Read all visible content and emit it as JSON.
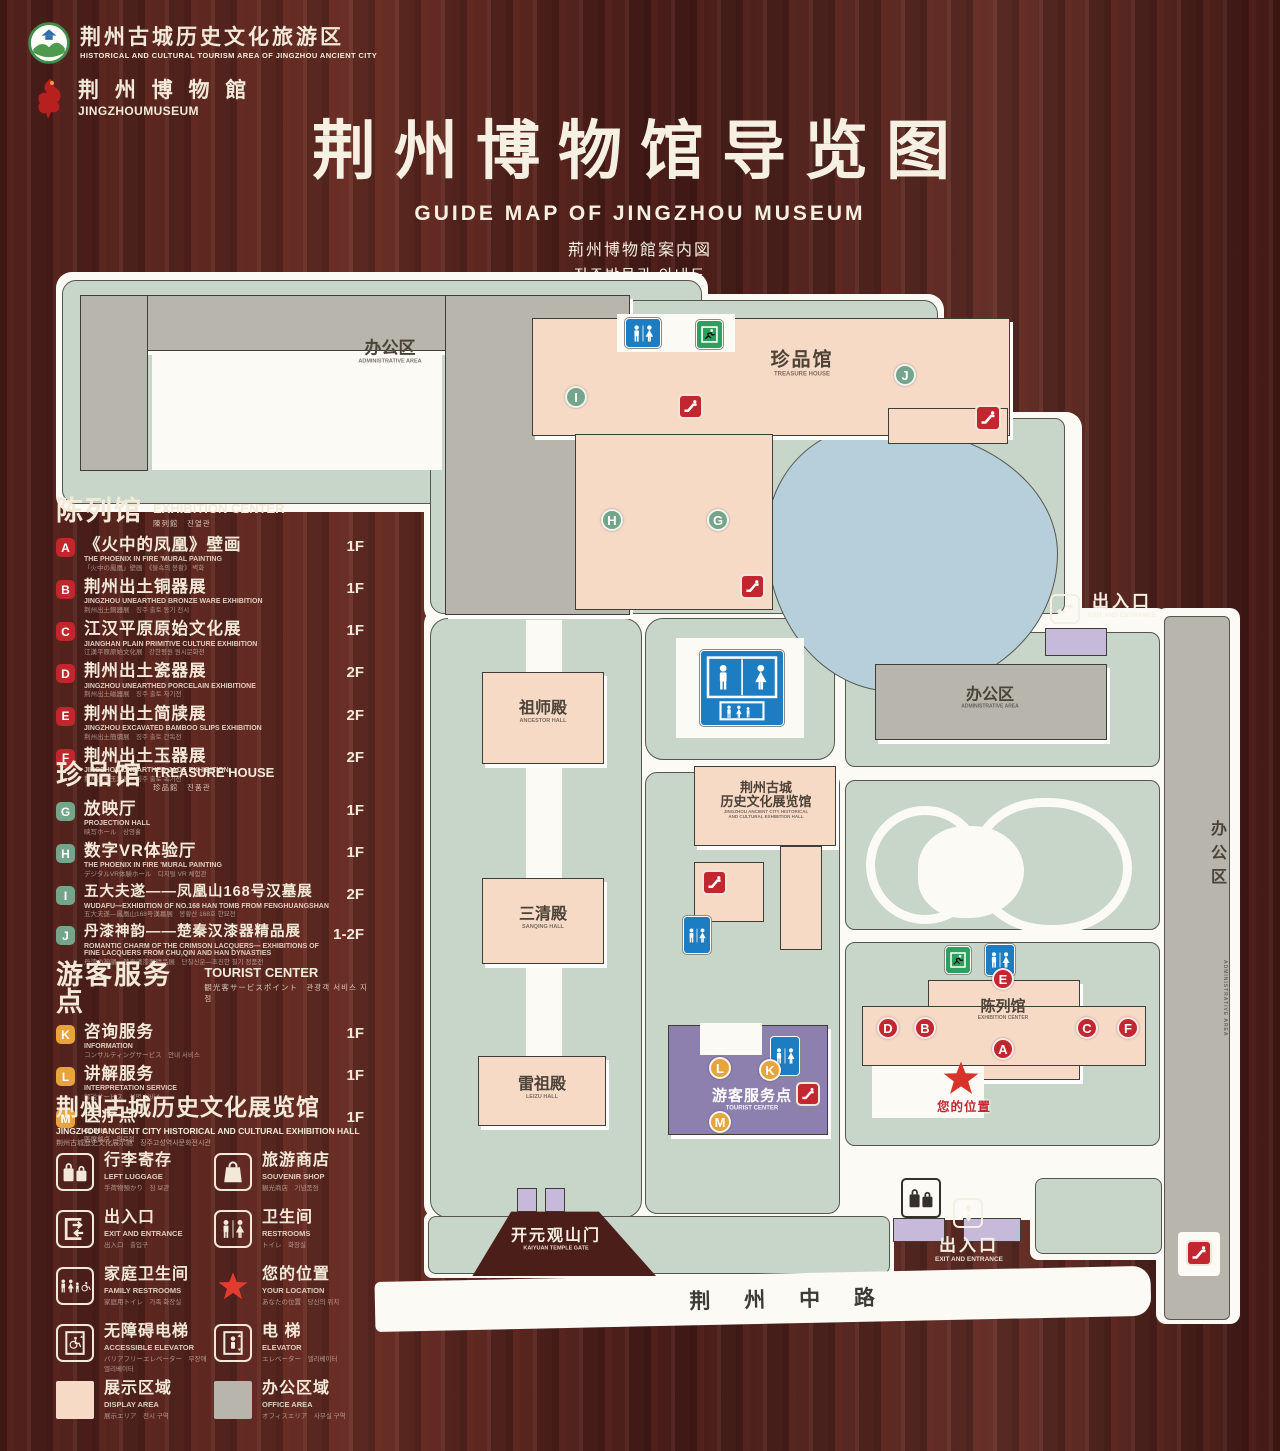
{
  "header": {
    "logo1": {
      "zh": "荆州古城历史文化旅游区",
      "en": "HISTORICAL AND CULTURAL TOURISM AREA OF JINGZHOU ANCIENT CITY"
    },
    "logo2": {
      "zh": "荆 州 博 物 館",
      "en": "JINGZHOUMUSEUM"
    },
    "title_zh": "荆州博物馆导览图",
    "title_en": "GUIDE MAP OF JINGZHOU MUSEUM",
    "title_ja": "荊州博物館案内図",
    "title_ko": "징주박물관 안내도"
  },
  "legend": {
    "exhibition": {
      "title_zh": "陈列馆",
      "title_en": "EXHIBITION CENTER",
      "title_sub": "陳列館　진열관",
      "items": [
        {
          "letter": "A",
          "zh": "《火中的凤凰》壁画",
          "en": "THE PHOENIX IN FIRE 'MURAL PAINTING",
          "sub": "「火中の鳳凰」壁画　《불속의 봉황》 벽화",
          "floor": "1F"
        },
        {
          "letter": "B",
          "zh": "荆州出土铜器展",
          "en": "JINGZHOU UNEARTHED BRONZE WARE EXHIBITION",
          "sub": "荆州出土銅器展　징주 출토 동기 전시",
          "floor": "1F"
        },
        {
          "letter": "C",
          "zh": "江汉平原原始文化展",
          "en": "JIANGHAN PLAIN PRIMITIVE CULTURE EXHIBITION",
          "sub": "江漢平原原始文化展　강한평원 원시문화전",
          "floor": "1F"
        },
        {
          "letter": "D",
          "zh": "荆州出土瓷器展",
          "en": "JINGZHOU UNEARTHED PORCELAIN EXHIBITIONE",
          "sub": "荆州出土磁器展　징주 출토 자기전",
          "floor": "2F"
        },
        {
          "letter": "E",
          "zh": "荆州出土简牍展",
          "en": "JINGZHOU EXCAVATED BAMBOO SLIPS EXHIBITION",
          "sub": "荆州出土簡牘展　징주 출토 간독전",
          "floor": "2F"
        },
        {
          "letter": "F",
          "zh": "荆州出土玉器展",
          "en": "JINGZHOU UNEARTHED JADE EXHIBITION",
          "sub": "荆州出土玉器展　징주 출토 옥기전",
          "floor": "2F"
        }
      ]
    },
    "treasure": {
      "title_zh": "珍品馆",
      "title_en": "TREASURE HOUSE",
      "title_sub": "珍品館　진품관",
      "items": [
        {
          "letter": "G",
          "zh": "放映厅",
          "en": "PROJECTION HALL",
          "sub": "映写ホール　상영홀",
          "floor": "1F"
        },
        {
          "letter": "H",
          "zh": "数字VR体验厅",
          "en": "THE PHOENIX IN FIRE 'MURAL PAINTING",
          "sub": "デジタルVR体験ホール　디지털 VR 체험관",
          "floor": "1F"
        },
        {
          "letter": "I",
          "zh": "五大夫遂——凤凰山168号汉墓展",
          "en": "WUDAFU—EXHIBITION OF NO.168 HAN TOMB FROM FENGHUANGSHAN",
          "sub": "五大夫遂—鳳凰山168号漢墓展　봉황산 168호 한묘전",
          "floor": "2F"
        },
        {
          "letter": "J",
          "zh": "丹漆神韵——楚秦汉漆器精品展",
          "en": "ROMANTIC CHARM OF THE CRIMSON LACQUERS— EXHIBITIONS OF FINE LACQUERS FROM CHU,QIN AND HAN DYNASTIES",
          "sub": "丹漆の神韻—楚秦漢漆器精品展　단칠신운—초진한 칠기 정품전",
          "floor": "1-2F"
        }
      ]
    },
    "tourist": {
      "title_zh": "游客服务点",
      "title_en": "TOURIST CENTER",
      "title_sub": "観光客サービスポイント　관광객 서비스 지점",
      "items": [
        {
          "letter": "K",
          "zh": "咨询服务",
          "en": "INFORMATION",
          "sub": "コンサルティングサービス　안내 서비스",
          "floor": "1F"
        },
        {
          "letter": "L",
          "zh": "讲解服务",
          "en": "INTERPRETATION SERVICE",
          "sub": "解説サービス　설명 서비스",
          "floor": "1F"
        },
        {
          "letter": "M",
          "zh": "医疗点",
          "en": "CLINIC",
          "sub": "医療拠点　의료점",
          "floor": "1F"
        }
      ]
    },
    "hall_note": {
      "zh": "荆州古城历史文化展览馆",
      "en": "JINGZHOU ANCIENT CITY HISTORICAL AND CULTURAL EXHIBITION HALL",
      "sub": "荆州古城歴史文化展示館　징주고성역사문화전시관"
    },
    "facilities": [
      {
        "zh": "行李寄存",
        "en": "LEFT LUGGAGE",
        "sub": "手荷物預かり　짐 보관"
      },
      {
        "zh": "旅游商店",
        "en": "SOUVENIR SHOP",
        "sub": "観光商店　기념품점"
      },
      {
        "zh": "出入口",
        "en": "EXIT AND ENTRANCE",
        "sub": "出入口　출입구"
      },
      {
        "zh": "卫生间",
        "en": "RESTROOMS",
        "sub": "トイレ　화장실"
      },
      {
        "zh": "家庭卫生间",
        "en": "FAMILY RESTROOMS",
        "sub": "家庭用トイレ　가족 화장실"
      },
      {
        "zh": "您的位置",
        "en": "YOUR LOCATION",
        "sub": "あなたの位置　당신의 위치"
      },
      {
        "zh": "无障碍电梯",
        "en": "ACCESSIBLE ELEVATOR",
        "sub": "バリアフリーエレベーター　무장애 엘리베이터"
      },
      {
        "zh": "电 梯",
        "en": "ELEVATOR",
        "sub": "エレベーター　엘리베이터"
      },
      {
        "zh": "展示区域",
        "en": "DISPLAY AREA",
        "sub": "展示エリア　전시 구역"
      },
      {
        "zh": "办公区域",
        "en": "OFFICE AREA",
        "sub": "オフィスエリア　사무실 구역"
      }
    ]
  },
  "map": {
    "labels": {
      "admin_top": {
        "zh": "办公区",
        "en": "ADMINISTRATIVE AREA"
      },
      "treasure": {
        "zh": "珍品馆",
        "en": "TREASURE HOUSE"
      },
      "ancestor": {
        "zh": "祖师殿",
        "en": "ANCESTOR HALL"
      },
      "sanqing": {
        "zh": "三清殿",
        "en": "SANQING HALL"
      },
      "leizu": {
        "zh": "雷祖殿",
        "en": "LEIZU HALL"
      },
      "hall": {
        "zh1": "荆州古城",
        "zh2": "历史文化展览馆",
        "en1": "JINGZHOU ANCIENT CITY HISTORICAL",
        "en2": "AND CULTURAL EXHIBITION HALL"
      },
      "admin_right": {
        "zh": "办公区",
        "en": "ADMINISTRATIVE AREA"
      },
      "admin_strip": {
        "zh": "办公区",
        "en": "ADMINISTRATIVE AREA"
      },
      "exhibition": {
        "zh": "陈列馆",
        "en": "EXHIBITION CENTER"
      },
      "tourist": {
        "zh": "游客服务点",
        "en": "TOURIST CENTER"
      },
      "gate": {
        "zh": "开元观山门",
        "en": "KAIYUAN TEMPLE GATE"
      },
      "exit_top": {
        "zh": "出入口",
        "en": "EXIT AND ENTRANCE"
      },
      "exit_bottom": {
        "zh": "出入口",
        "en": "EXIT AND ENTRANCE"
      },
      "your_location": "您的位置",
      "road": "荆 州 中 路"
    },
    "letters": {
      "a": "A",
      "b": "B",
      "c": "C",
      "d": "D",
      "e": "E",
      "f": "F",
      "g": "G",
      "h": "H",
      "i": "I",
      "j": "J",
      "k": "K",
      "l": "L",
      "m": "M"
    }
  },
  "colors": {
    "wood": "#54241f",
    "land_green": "#c7d6c8",
    "building_pink": "#f7dac6",
    "building_gray": "#b7b5ac",
    "pond_blue": "#b7cedb",
    "tourist_purple": "#8d80af",
    "lavender": "#c7b9d9",
    "badge_red": "#c2262e",
    "badge_green": "#74a489",
    "badge_yellow": "#e7a33c",
    "restroom_blue": "#1d7dc2",
    "exit_green": "#2ca05c",
    "cream_text": "#f2e9d8",
    "path_white": "#fbfaf5"
  }
}
